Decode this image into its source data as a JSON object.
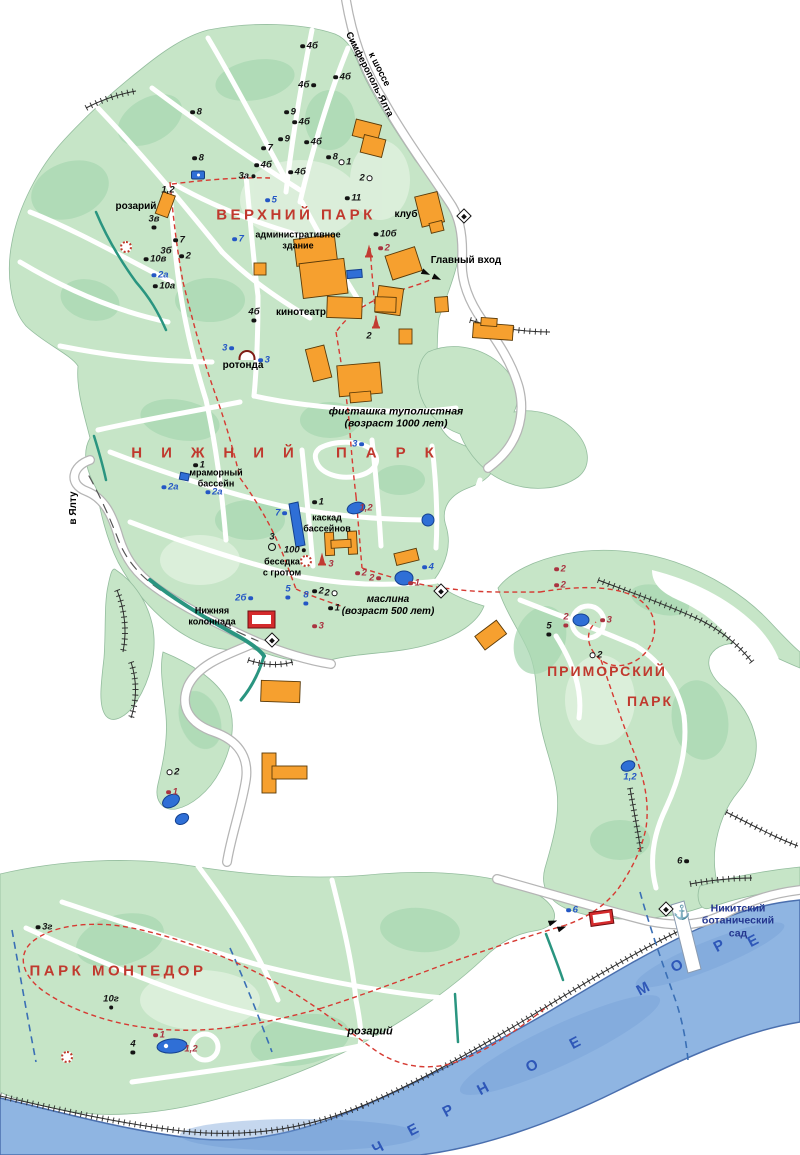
{
  "map_title": "Никитский ботанический сад — схема парков",
  "colors": {
    "park_green": "#c6e5c7",
    "park_green_dark": "#a8d7b2",
    "park_green_light": "#ddefdc",
    "sea": "#8fb5e2",
    "sea_deep": "#6f9cd4",
    "sea_text": "#2e57b8",
    "title_red": "#c0392e",
    "route_red": "#d63a32",
    "stream_teal": "#2a9580",
    "building_orange": "#f6a02f",
    "building_red": "#d42a2c",
    "water_blue": "#2f6fd6",
    "dash_blue": "#3a6fb5",
    "label_navy": "#23368f"
  },
  "region_titles": [
    {
      "text": "ВЕРХНИЙ ПАРК",
      "x": 296,
      "y": 215,
      "fs": 15,
      "ls": 3.5
    },
    {
      "text": "НИЖНИЙ ПАРК",
      "x": 292,
      "y": 453,
      "fs": 15,
      "ls": 19
    },
    {
      "text": "ПРИМОРСКИЙ",
      "x": 607,
      "y": 671,
      "fs": 14,
      "ls": 2
    },
    {
      "text": "ПАРК",
      "x": 650,
      "y": 701,
      "fs": 14,
      "ls": 2
    },
    {
      "text": "ПАРК МОНТЕДОР",
      "x": 118,
      "y": 971,
      "fs": 15,
      "ls": 3.5
    }
  ],
  "labels": [
    {
      "text": "к шоссе\nСимферополь-Ялта",
      "x": 374,
      "y": 72,
      "fs": 9.5,
      "rot": 63
    },
    {
      "text": "розарий",
      "x": 136,
      "y": 207,
      "fs": 10
    },
    {
      "text": "административное\nздание",
      "x": 298,
      "y": 240,
      "fs": 9
    },
    {
      "text": "клуб",
      "x": 406,
      "y": 215,
      "fs": 10
    },
    {
      "text": "Главный вход",
      "x": 466,
      "y": 261,
      "fs": 10
    },
    {
      "text": "кинотеатр",
      "x": 301,
      "y": 313,
      "fs": 10
    },
    {
      "text": "ротонда",
      "x": 243,
      "y": 366,
      "fs": 10
    },
    {
      "text": "фисташка туполистная\n(возраст 1000 лет)",
      "x": 396,
      "y": 418,
      "fs": 10.5,
      "italic": 1
    },
    {
      "text": "мраморный\nбассейн",
      "x": 216,
      "y": 478,
      "fs": 9
    },
    {
      "text": "каскад\nбассейнов",
      "x": 327,
      "y": 523,
      "fs": 9
    },
    {
      "text": "беседка\nс гротом",
      "x": 282,
      "y": 567,
      "fs": 9
    },
    {
      "text": "маслина\n(возраст 500 лет)",
      "x": 388,
      "y": 606,
      "fs": 10,
      "italic": 1
    },
    {
      "text": "Нижняя\nколоннада",
      "x": 212,
      "y": 616,
      "fs": 9
    },
    {
      "text": "в Ялту",
      "x": 74,
      "y": 508,
      "fs": 10,
      "rot": -90
    },
    {
      "text": "розарий",
      "x": 370,
      "y": 1032,
      "fs": 11,
      "italic": 1
    },
    {
      "text": "Никитский\nботанический сад",
      "x": 738,
      "y": 921,
      "fs": 10.5,
      "color": "#23368f"
    }
  ],
  "sea_label": {
    "name": "ЧЕРНОЕ МОРЕ",
    "rot": -28,
    "letters": [
      {
        "ch": "Ч",
        "x": 378,
        "y": 1148
      },
      {
        "ch": "Е",
        "x": 413,
        "y": 1130
      },
      {
        "ch": "Р",
        "x": 448,
        "y": 1111
      },
      {
        "ch": "Н",
        "x": 483,
        "y": 1089
      },
      {
        "ch": "О",
        "x": 532,
        "y": 1066
      },
      {
        "ch": "Е",
        "x": 575,
        "y": 1043
      },
      {
        "ch": "М",
        "x": 643,
        "y": 989
      },
      {
        "ch": "О",
        "x": 677,
        "y": 966
      },
      {
        "ch": "Р",
        "x": 719,
        "y": 946
      },
      {
        "ch": "Е",
        "x": 753,
        "y": 941
      }
    ]
  },
  "markers": [
    {
      "t": "4б",
      "x": 309,
      "y": 46,
      "c": "k",
      "d": "l"
    },
    {
      "t": "4б",
      "x": 307,
      "y": 85,
      "c": "k",
      "d": "r"
    },
    {
      "t": "4б",
      "x": 342,
      "y": 77,
      "c": "k",
      "d": "l"
    },
    {
      "t": "8",
      "x": 196,
      "y": 112,
      "c": "k",
      "d": "l"
    },
    {
      "t": "9",
      "x": 290,
      "y": 112,
      "c": "k",
      "d": "l"
    },
    {
      "t": "4б",
      "x": 301,
      "y": 122,
      "c": "k",
      "d": "l"
    },
    {
      "t": "9",
      "x": 284,
      "y": 139,
      "c": "k",
      "d": "l"
    },
    {
      "t": "7",
      "x": 267,
      "y": 148,
      "c": "k",
      "d": "l"
    },
    {
      "t": "4б",
      "x": 313,
      "y": 142,
      "c": "k",
      "d": "l"
    },
    {
      "t": "8",
      "x": 198,
      "y": 158,
      "c": "k",
      "d": "l"
    },
    {
      "t": "8",
      "x": 332,
      "y": 157,
      "c": "k",
      "d": "l"
    },
    {
      "t": "1",
      "x": 345,
      "y": 162,
      "c": "k",
      "d": "ol"
    },
    {
      "t": "4б",
      "x": 263,
      "y": 165,
      "c": "k",
      "d": "l"
    },
    {
      "t": "3а",
      "x": 247,
      "y": 176,
      "c": "k",
      "d": "r"
    },
    {
      "t": "4б",
      "x": 297,
      "y": 172,
      "c": "k",
      "d": "l"
    },
    {
      "t": "2",
      "x": 366,
      "y": 178,
      "c": "k",
      "d": "or"
    },
    {
      "t": "1,2",
      "x": 168,
      "y": 190,
      "c": "k",
      "d": "n"
    },
    {
      "t": "3в",
      "x": 154,
      "y": 222,
      "c": "k",
      "d": "b"
    },
    {
      "t": "5",
      "x": 271,
      "y": 200,
      "c": "b",
      "d": "l"
    },
    {
      "t": "11",
      "x": 353,
      "y": 198,
      "c": "k",
      "d": "l"
    },
    {
      "t": "7",
      "x": 238,
      "y": 239,
      "c": "b",
      "d": "l"
    },
    {
      "t": "7",
      "x": 179,
      "y": 240,
      "c": "k",
      "d": "l"
    },
    {
      "t": "3б",
      "x": 166,
      "y": 251,
      "c": "k",
      "d": "n"
    },
    {
      "t": "2",
      "x": 185,
      "y": 256,
      "c": "k",
      "d": "l"
    },
    {
      "t": "10в",
      "x": 155,
      "y": 259,
      "c": "k",
      "d": "l"
    },
    {
      "t": "2а",
      "x": 160,
      "y": 275,
      "c": "b",
      "d": "l"
    },
    {
      "t": "10а",
      "x": 164,
      "y": 286,
      "c": "k",
      "d": "l"
    },
    {
      "t": "10б",
      "x": 385,
      "y": 234,
      "c": "k",
      "d": "l"
    },
    {
      "t": "2",
      "x": 384,
      "y": 248,
      "c": "r",
      "d": "l"
    },
    {
      "t": "4б",
      "x": 254,
      "y": 315,
      "c": "k",
      "d": "b"
    },
    {
      "t": "2",
      "x": 369,
      "y": 336,
      "c": "k",
      "d": "n"
    },
    {
      "t": "3",
      "x": 228,
      "y": 348,
      "c": "b",
      "d": "r"
    },
    {
      "t": "3",
      "x": 264,
      "y": 360,
      "c": "b",
      "d": "l"
    },
    {
      "t": "3",
      "x": 358,
      "y": 444,
      "c": "b",
      "d": "r"
    },
    {
      "t": "1",
      "x": 199,
      "y": 465,
      "c": "k",
      "d": "l"
    },
    {
      "t": "2а",
      "x": 170,
      "y": 487,
      "c": "b",
      "d": "l"
    },
    {
      "t": "2а",
      "x": 214,
      "y": 492,
      "c": "b",
      "d": "l"
    },
    {
      "t": "7",
      "x": 281,
      "y": 513,
      "c": "b",
      "d": "r"
    },
    {
      "t": "1",
      "x": 318,
      "y": 502,
      "c": "k",
      "d": "l"
    },
    {
      "t": "1,2",
      "x": 366,
      "y": 508,
      "c": "r",
      "d": "n"
    },
    {
      "t": "3",
      "x": 272,
      "y": 537,
      "c": "k",
      "d": "n"
    },
    {
      "t": "100",
      "x": 295,
      "y": 550,
      "c": "k",
      "d": "r"
    },
    {
      "t": "3",
      "x": 331,
      "y": 564,
      "c": "r",
      "d": "n"
    },
    {
      "t": "2",
      "x": 361,
      "y": 573,
      "c": "r",
      "d": "l"
    },
    {
      "t": "2",
      "x": 375,
      "y": 578,
      "c": "r",
      "d": "r"
    },
    {
      "t": "4",
      "x": 428,
      "y": 567,
      "c": "b",
      "d": "l"
    },
    {
      "t": "1",
      "x": 414,
      "y": 583,
      "c": "r",
      "d": "l"
    },
    {
      "t": "2б",
      "x": 244,
      "y": 598,
      "c": "b",
      "d": "r"
    },
    {
      "t": "5",
      "x": 288,
      "y": 592,
      "c": "b",
      "d": "b"
    },
    {
      "t": "8",
      "x": 306,
      "y": 598,
      "c": "b",
      "d": "b"
    },
    {
      "t": "2",
      "x": 318,
      "y": 591,
      "c": "k",
      "d": "l"
    },
    {
      "t": "2",
      "x": 331,
      "y": 593,
      "c": "k",
      "d": "or"
    },
    {
      "t": "1",
      "x": 334,
      "y": 608,
      "c": "k",
      "d": "l"
    },
    {
      "t": "3",
      "x": 318,
      "y": 626,
      "c": "r",
      "d": "l"
    },
    {
      "t": "2",
      "x": 560,
      "y": 569,
      "c": "r",
      "d": "l"
    },
    {
      "t": "2",
      "x": 560,
      "y": 585,
      "c": "r",
      "d": "l"
    },
    {
      "t": "2",
      "x": 566,
      "y": 620,
      "c": "r",
      "d": "b"
    },
    {
      "t": "3",
      "x": 606,
      "y": 620,
      "c": "r",
      "d": "l"
    },
    {
      "t": "5",
      "x": 549,
      "y": 629,
      "c": "k",
      "d": "b"
    },
    {
      "t": "2",
      "x": 596,
      "y": 655,
      "c": "k",
      "d": "ol"
    },
    {
      "t": "1,2",
      "x": 630,
      "y": 777,
      "c": "b",
      "d": "n"
    },
    {
      "t": "6",
      "x": 683,
      "y": 861,
      "c": "k",
      "d": "r"
    },
    {
      "t": "2",
      "x": 173,
      "y": 772,
      "c": "k",
      "d": "ol"
    },
    {
      "t": "1",
      "x": 172,
      "y": 792,
      "c": "r",
      "d": "l"
    },
    {
      "t": "3г",
      "x": 44,
      "y": 927,
      "c": "k",
      "d": "l"
    },
    {
      "t": "10г",
      "x": 111,
      "y": 1002,
      "c": "k",
      "d": "b"
    },
    {
      "t": "4",
      "x": 133,
      "y": 1047,
      "c": "k",
      "d": "b"
    },
    {
      "t": "1",
      "x": 159,
      "y": 1035,
      "c": "r",
      "d": "l"
    },
    {
      "t": "1,2",
      "x": 191,
      "y": 1049,
      "c": "r",
      "d": "n"
    },
    {
      "t": "6",
      "x": 572,
      "y": 910,
      "c": "b",
      "d": "l"
    }
  ],
  "icons": [
    {
      "type": "viewpoint",
      "x": 464,
      "y": 216,
      "rot": 45
    },
    {
      "type": "viewpoint",
      "x": 272,
      "y": 640,
      "rot": 45
    },
    {
      "type": "viewpoint",
      "x": 441,
      "y": 591,
      "rot": 45
    },
    {
      "type": "viewpoint",
      "x": 666,
      "y": 909,
      "rot": 45
    },
    {
      "type": "anchor",
      "x": 682,
      "y": 912
    },
    {
      "type": "monument",
      "x": 369,
      "y": 250
    },
    {
      "type": "monument",
      "x": 376,
      "y": 321
    },
    {
      "type": "monument",
      "x": 322,
      "y": 558
    },
    {
      "type": "flower",
      "x": 126,
      "y": 247
    },
    {
      "type": "flower",
      "x": 306,
      "y": 561
    },
    {
      "type": "flower",
      "x": 67,
      "y": 1057
    },
    {
      "type": "rotunda",
      "x": 247,
      "y": 355
    },
    {
      "type": "gate",
      "x": 426,
      "y": 273,
      "rot": 25
    },
    {
      "type": "gate",
      "x": 437,
      "y": 278,
      "rot": 25
    },
    {
      "type": "gate",
      "x": 553,
      "y": 922,
      "rot": -20
    },
    {
      "type": "gate",
      "x": 562,
      "y": 928,
      "rot": -20
    },
    {
      "type": "bluebox",
      "x": 198,
      "y": 175
    },
    {
      "type": "circle",
      "x": 272,
      "y": 547
    }
  ]
}
